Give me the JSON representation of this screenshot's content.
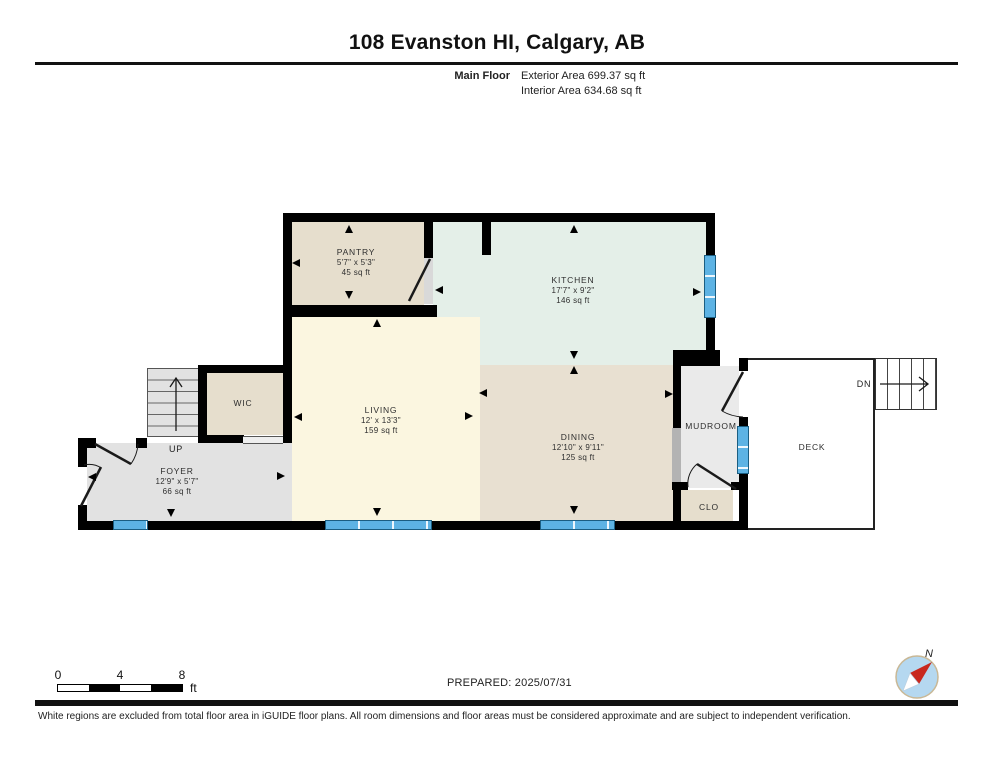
{
  "header": {
    "title": "108 Evanston HI, Calgary, AB",
    "floor_label": "Main Floor",
    "exterior_area": "Exterior Area 699.37 sq ft",
    "interior_area": "Interior Area 634.68 sq ft"
  },
  "rooms": {
    "pantry": {
      "name": "PANTRY",
      "dims": "5'7\" x 5'3\"",
      "area": "45 sq ft",
      "color": "#e6decd"
    },
    "kitchen": {
      "name": "KITCHEN",
      "dims": "17'7\" x 9'2\"",
      "area": "146 sq ft",
      "color": "#e4efe8"
    },
    "living": {
      "name": "LIVING",
      "dims": "12' x 13'3\"",
      "area": "159 sq ft",
      "color": "#fbf6e0"
    },
    "dining": {
      "name": "DINING",
      "dims": "12'10\" x 9'11\"",
      "area": "125 sq ft",
      "color": "#e8e0d1"
    },
    "foyer": {
      "name": "FOYER",
      "dims": "12'9\" x 5'7\"",
      "area": "66 sq ft",
      "color": "#e2e2e2"
    },
    "wic": {
      "name": "WIC",
      "color": "#e6decd"
    },
    "mudroom": {
      "name": "MUDROOM",
      "color": "#eaeaea"
    },
    "clo": {
      "name": "CLO",
      "color": "#e6decd"
    },
    "deck": {
      "name": "DECK",
      "color": "#ffffff"
    }
  },
  "stairs": {
    "up_label": "UP",
    "down_label": "DN"
  },
  "scale_bar": {
    "labels": [
      "0",
      "4",
      "8"
    ],
    "unit": "ft"
  },
  "compass": {
    "north_label": "N",
    "needle_color": "#c8281e",
    "disc_color": "#b5d8f0"
  },
  "footer": {
    "prepared": "PREPARED: 2025/07/31",
    "disclaimer": "White regions are excluded from total floor area in iGUIDE floor plans. All room dimensions and floor areas must be considered approximate and are subject to independent verification."
  },
  "colors": {
    "wall": "#000000",
    "window": "#5db3e4"
  }
}
